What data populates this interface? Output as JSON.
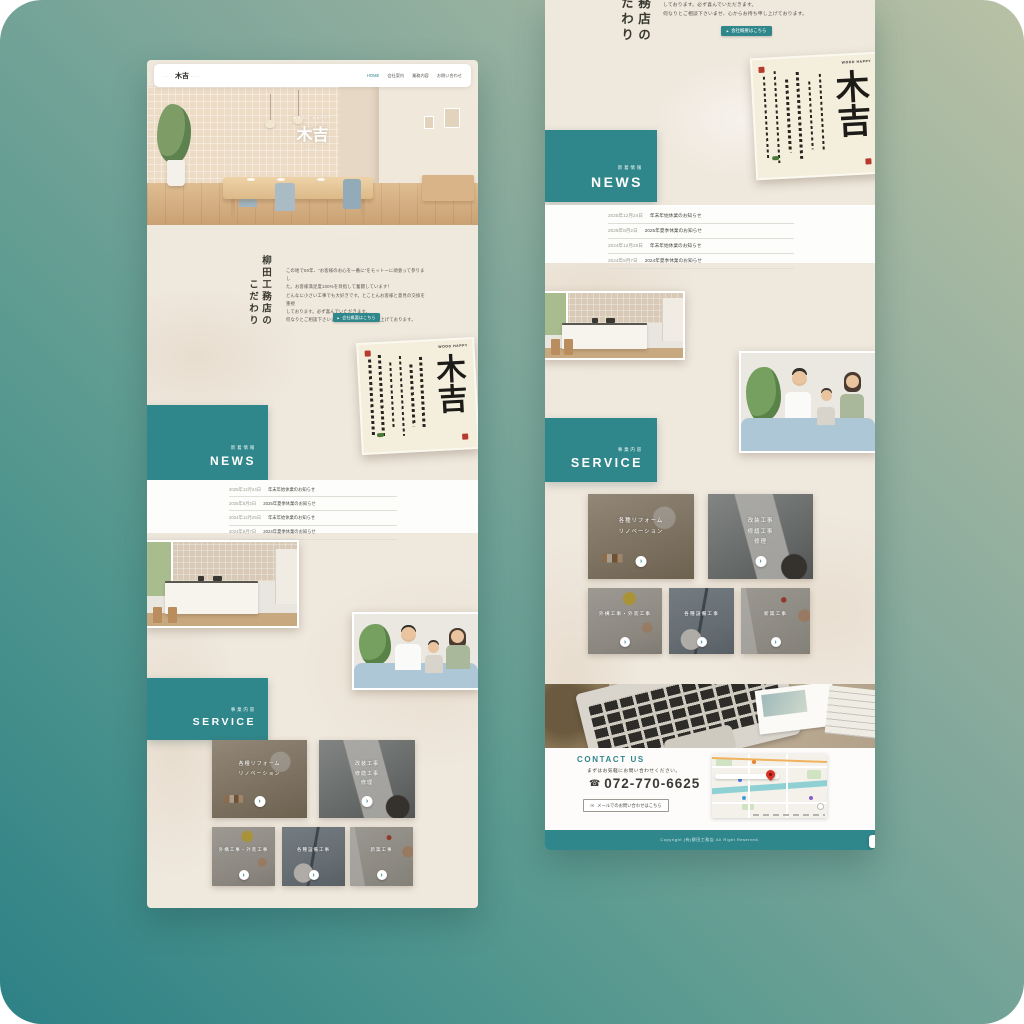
{
  "site": {
    "brand": "木吉",
    "brand_deco": "·····",
    "tagline_en": "WOOD HAPPY",
    "hero_dots": "••••",
    "nav": [
      {
        "label": "HOME"
      },
      {
        "label": "会社案内"
      },
      {
        "label": "業務内容"
      },
      {
        "label": "お問い合わせ"
      }
    ]
  },
  "concept": {
    "title_line1": "柳田工務店の",
    "title_line2": "こだわり",
    "body_lines": [
      "この地で50年、“お客様のお心を一番に”をモットーに頑張って参りまし",
      "た。お客様満足度100%を目指して奮闘しています！",
      "どんなに小さい工事でも大好きです。とことんお客様と意見の交換を重視",
      "しております。必ず喜んでいただきます。",
      "何なりとご相談下さいませ、心からお待ち申し上げております。"
    ],
    "cta_arrow": "▶",
    "cta_label": "会社概要はこちら"
  },
  "calligraphy": {
    "main": "木吉",
    "sub": "WOOD HAPPY"
  },
  "news": {
    "label_jp": "新着情報",
    "label_en": "NEWS",
    "items": [
      {
        "date": "2025年12月24日",
        "title": "年末年始休業のお知らせ"
      },
      {
        "date": "2025年8月2日",
        "title": "2025年夏季休業のお知らせ"
      },
      {
        "date": "2024年12月25日",
        "title": "年末年始休業のお知らせ"
      },
      {
        "date": "2024年8月7日",
        "title": "2024年夏季休業のお知らせ"
      }
    ]
  },
  "service": {
    "label_jp": "事業内容",
    "label_en": "SERVICE",
    "arrow": "›",
    "cards": [
      {
        "lines": [
          "各種リフォーム",
          "リノベーション"
        ]
      },
      {
        "lines": [
          "改装工事",
          "修繕工事",
          "修理"
        ]
      },
      {
        "lines": [
          "外構工事・外装工事"
        ]
      },
      {
        "lines": [
          "各種設備工事"
        ]
      },
      {
        "lines": [
          "新築工事"
        ]
      }
    ]
  },
  "contact": {
    "heading": "CONTACT US",
    "lead": "まずはお気軽にお問い合わせください。",
    "phone_icon": "☎",
    "phone": "072-770-6625",
    "mail_icon": "✉",
    "mail_button": "メールでのお問い合わせはこちら"
  },
  "footer": {
    "copyright": "Copyright (有)柳田工務店 All Right Reserved."
  },
  "colors": {
    "teal": "#2F878B",
    "paper": "#EFE8DD"
  }
}
